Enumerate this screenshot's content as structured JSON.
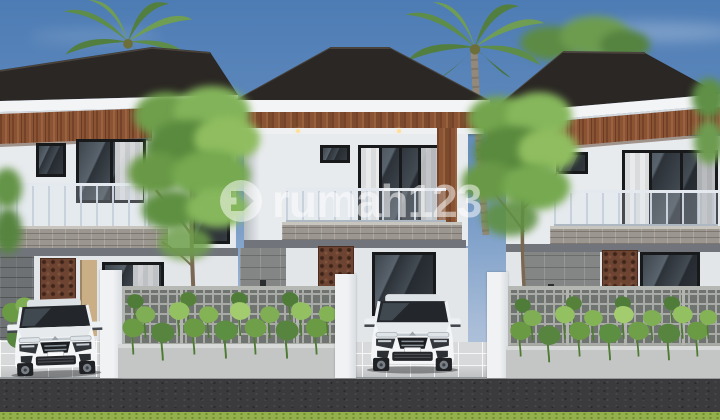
{
  "watermark": {
    "text": "rumah123",
    "logo": "rumah123-house-in-circle",
    "color": "#ffffff",
    "opacity": 0.52
  },
  "scene": {
    "type": "architectural-exterior-render",
    "houses": [
      {
        "name": "left-house",
        "storeys": 2
      },
      {
        "name": "middle-house",
        "storeys": 2
      },
      {
        "name": "right-house",
        "storeys": 2
      }
    ],
    "cars": [
      {
        "name": "white-mpv-left-driveway",
        "color": "#f3f5f7"
      },
      {
        "name": "white-mpv-middle-driveway",
        "color": "#f3f5f7"
      }
    ],
    "vegetation": [
      "palm-tree-behind-left-house",
      "palm-tree-between-middle-and-right-house",
      "tree-left-foreground",
      "tree-right-foreground",
      "taro-plants-in-fence-planters"
    ],
    "colors": {
      "sky_top": "#4d7cb4",
      "sky_horizon": "#c3cfe2",
      "roof": "#2b2623",
      "fascia": "#f3f4f6",
      "wood_accent": "#8a5434",
      "wall": "#e8ebee",
      "window_frame": "#17191b",
      "balcony_stone": "#9b968f",
      "breeze_block_fence": "#9fa19d",
      "rust_carved_panel": "#6d4331",
      "leaf_green": "#7fae54",
      "road_asphalt": "#3b3b3d",
      "grass": "#93b04b"
    }
  }
}
